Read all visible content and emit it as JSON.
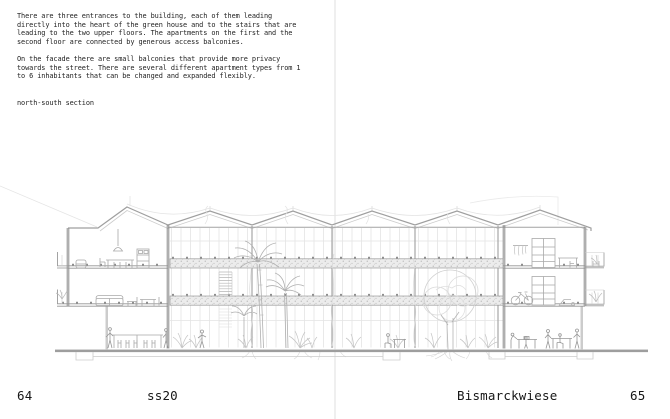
{
  "description": {
    "paragraph1": "There are three entrances to the building, each of them leading\ndirectly into the heart of the green house and to the stairs that are\nleading to the two upper floors. The apartments on the first and the\nsecond floor are connected by generous access balconies.",
    "paragraph2": "On the facade there are small balconies that provide more privacy\ntowards the street. There are several different apartment types from 1\nto 6 inhabitants that can be changed and expanded flexibly.",
    "caption": "north-south section"
  },
  "footer": {
    "left_page_number": "64",
    "semester": "ss20",
    "project_name": "Bismarckwiese",
    "right_page_number": "65"
  },
  "drawing_colors": {
    "line_light": "#cccccc",
    "line_mid": "#9a9a9a",
    "line_dark": "#8a8a8a",
    "walkway_hatch_base": "#ececec",
    "ground": "#9e9e9e",
    "fold_line": "#efefef"
  }
}
